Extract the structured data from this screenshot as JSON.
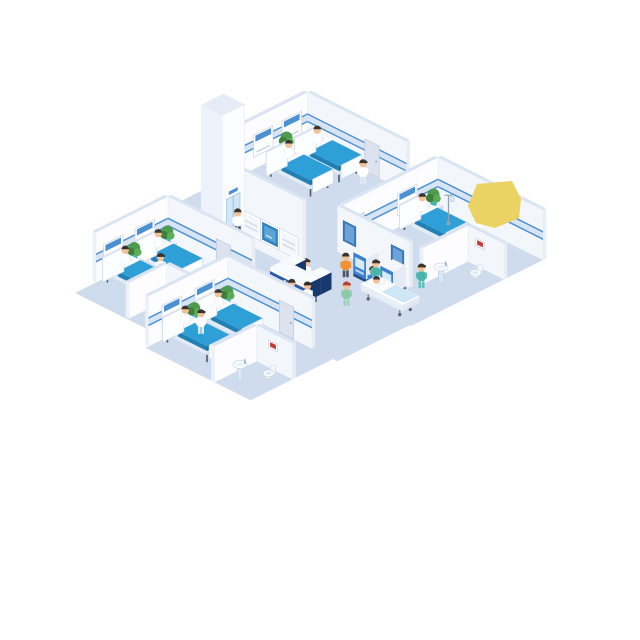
{
  "scene": {
    "description": "isometric-hospital-ward-floor-illustration",
    "desk_label": "PSN"
  },
  "palette": {
    "floor": "#cfdcee",
    "wallFaceA": "#fdfdff",
    "wallFaceB": "#f3f6fb",
    "wallTop": "#dbe4f3",
    "band": "#4a90d2",
    "bandLight": "#d6e4f4",
    "bedBlue": "#2f9fd8",
    "bedDark": "#2180b4",
    "bedEnd": "#1b6f9f",
    "leg": "#4e5a6a",
    "door": "#dde3ee",
    "desk": "#2a5ca8",
    "deskDark": "#17396e",
    "deskBand": "#0f3264",
    "kiosk": "#3d7fd0",
    "screen": "#2f86c8",
    "plant": "#4f9d4c",
    "plantDark": "#3f7f3c",
    "pot": "#49b4ac",
    "skin": "#f2c196",
    "yellow": "#ead263",
    "poster": "#3f7fc4",
    "sign": "#c43b34",
    "teal": "#4ab4aa",
    "green": "#8ccbaa",
    "orange": "#f0922e",
    "blue": "#3d7fd0"
  },
  "items": [
    {
      "t": "floor",
      "name": "floor-main-wing",
      "u1": 0,
      "v1": 0,
      "u2": 16,
      "v2": 8.8
    },
    {
      "t": "floor",
      "name": "floor-corridor",
      "u1": 2.6,
      "v1": 8.8,
      "u2": 15.9,
      "v2": 13.6
    },
    {
      "t": "floor",
      "name": "floor-left-wing",
      "u1": 2.6,
      "v1": 11.6,
      "u2": 8.6,
      "v2": 17.8
    },
    {
      "t": "floor",
      "name": "floor-bottom-wing",
      "u1": 8.6,
      "v1": 13.6,
      "u2": 15.6,
      "v2": 19.1
    },
    {
      "t": "wallA",
      "name": "top-room-headwall",
      "u": 0.3,
      "v1": 4.7,
      "v2": 0,
      "h": 50,
      "band": 1,
      "panels": [
        1.05,
        2.95
      ]
    },
    {
      "t": "wallB",
      "name": "top-room-back-wall",
      "v": 0,
      "u1": 0.3,
      "u2": 6.9,
      "h": 50,
      "band": 1,
      "door": 4.6
    },
    {
      "t": "plant",
      "name": "plant",
      "u": 0.5,
      "v": 1.6
    },
    {
      "t": "bed",
      "name": "patient-bed",
      "u": 1.2,
      "v": 0.3
    },
    {
      "t": "bed",
      "name": "patient-bed",
      "u": 1.2,
      "v": 2.2
    },
    {
      "t": "person",
      "name": "nurse",
      "u": 4.9,
      "v": 0.9,
      "role": "nurse"
    },
    {
      "t": "wallB",
      "name": "right-room-back-wall",
      "v": 0,
      "u1": 9.0,
      "u2": 16.0,
      "h": 50,
      "band": 1
    },
    {
      "t": "wallA",
      "name": "right-room-headwall",
      "u": 9.0,
      "v1": 6.3,
      "v2": 0,
      "h": 50,
      "band": 1,
      "panels": [
        2.05
      ],
      "door": 5.4
    },
    {
      "t": "plant",
      "name": "plant",
      "u": 9.2,
      "v": 0.5
    },
    {
      "t": "bed",
      "name": "patient-bed",
      "u": 9.2,
      "v": 1.3
    },
    {
      "t": "iv",
      "name": "iv-stand",
      "u": 10.4,
      "v": 0.7
    },
    {
      "t": "person",
      "name": "doctor",
      "u": 12.2,
      "v": 0.6,
      "role": "doctor"
    },
    {
      "t": "blob",
      "name": "yellow-shape",
      "pts": [
        [
          477,
          184
        ],
        [
          512,
          181
        ],
        [
          521,
          199
        ],
        [
          519,
          218
        ],
        [
          495,
          228
        ],
        [
          476,
          223
        ],
        [
          468,
          206
        ]
      ]
    },
    {
      "t": "wallB",
      "name": "right-bathroom-wall",
      "v": 2.6,
      "u1": 13.6,
      "u2": 16.0,
      "h": 36,
      "sign": 14.4
    },
    {
      "t": "wallA",
      "name": "right-bathroom-partition",
      "u": 13.6,
      "v1": 5.6,
      "v2": 2.6,
      "h": 36
    },
    {
      "t": "sink",
      "name": "sink",
      "u": 14.1,
      "v": 4.9
    },
    {
      "t": "toilet",
      "name": "toilet",
      "u": 15.1,
      "v": 3.6
    },
    {
      "t": "wallB",
      "name": "corridor-wall",
      "v": 6.3,
      "u1": 8.6,
      "u2": 13.4,
      "h": 46,
      "posters": [
        9.4,
        12.6
      ]
    },
    {
      "t": "person",
      "name": "nurse",
      "u": 13.8,
      "v": 5.9,
      "role": "tealNurse"
    },
    {
      "t": "wallB",
      "name": "reception-back-wall",
      "v": 8.8,
      "u1": 4.5,
      "u2": 8.8,
      "h": 72,
      "windows": [
        [
          5.35,
          "panel"
        ],
        [
          6.6,
          "screen"
        ],
        [
          7.85,
          "panel"
        ]
      ]
    },
    {
      "t": "elevator",
      "name": "elevator-shaft",
      "u1": 2.0,
      "v1": 7.3,
      "u2": 3.4,
      "v2": 8.8,
      "h": 116
    },
    {
      "t": "person",
      "name": "person-waiting-elevator",
      "u": 4.0,
      "v": 8.35,
      "role": "visitor"
    },
    {
      "t": "kiosk",
      "name": "self-service-kiosk",
      "u": 10.75,
      "v": 6.55
    },
    {
      "t": "kiosk",
      "name": "self-service-kiosk",
      "u": 12.55,
      "v": 6.55
    },
    {
      "t": "person",
      "name": "kiosk-user",
      "u": 10.55,
      "v": 7.7,
      "role": "orange"
    },
    {
      "t": "person",
      "name": "kiosk-user",
      "u": 12.35,
      "v": 7.7,
      "role": "blueShirt"
    },
    {
      "t": "person",
      "name": "receptionist",
      "u": 9.6,
      "v": 9.4,
      "role": "nurse"
    },
    {
      "t": "desk",
      "name": "reception-desk",
      "u1": 8.5,
      "v1": 9.0,
      "u2": 10.9,
      "v2": 10.7,
      "h": 17
    },
    {
      "t": "person",
      "name": "nurse-with-gurney",
      "u": 12.0,
      "v": 7.15,
      "role": "tealNurse"
    },
    {
      "t": "gurney",
      "name": "patient-gurney",
      "u": 12.5,
      "v": 7.55
    },
    {
      "t": "person",
      "name": "nurse-walking",
      "u": 12.5,
      "v": 9.6,
      "role": "greenNurse"
    },
    {
      "t": "person",
      "name": "staff-walking",
      "u": 10.5,
      "v": 11.25,
      "role": "blueStaff"
    },
    {
      "t": "person",
      "name": "doctor-with-bag",
      "u": 11.2,
      "v": 10.9,
      "role": "doctor",
      "bag": true
    },
    {
      "t": "wallA",
      "name": "left-room-headwall",
      "u": 2.6,
      "v1": 16.4,
      "v2": 11.6,
      "h": 50,
      "band": 1,
      "panels": [
        13.15,
        15.25
      ]
    },
    {
      "t": "wallB",
      "name": "left-room-corridor-wall",
      "v": 11.6,
      "u1": 2.6,
      "u2": 8.2,
      "h": 50,
      "band": 1,
      "door": 6.3
    },
    {
      "t": "plant",
      "name": "plant",
      "u": 2.8,
      "v": 11.85
    },
    {
      "t": "bed",
      "name": "patient-bed",
      "u": 2.8,
      "v": 12.5
    },
    {
      "t": "plant",
      "name": "plant",
      "u": 2.8,
      "v": 14.05
    },
    {
      "t": "bed",
      "name": "patient-bed",
      "u": 2.8,
      "v": 14.7
    },
    {
      "t": "person",
      "name": "nurse",
      "u": 4.4,
      "v": 13.9,
      "role": "nurse"
    },
    {
      "t": "wallB",
      "name": "left-bathroom-wall",
      "v": 15.2,
      "u1": 6.1,
      "u2": 8.6,
      "h": 36,
      "sign": 7.2
    },
    {
      "t": "wallA",
      "name": "left-bathroom-partition",
      "u": 6.1,
      "v1": 17.7,
      "v2": 15.2,
      "h": 36
    },
    {
      "t": "sink",
      "name": "sink",
      "u": 6.8,
      "v": 16.7
    },
    {
      "t": "toilet",
      "name": "toilet",
      "u": 7.8,
      "v": 15.95
    },
    {
      "t": "wallA",
      "name": "bottom-room-headwall",
      "u": 8.6,
      "v1": 18.9,
      "v2": 13.6,
      "h": 50,
      "band": 1,
      "panels": [
        15.15,
        17.35
      ]
    },
    {
      "t": "wallB",
      "name": "bottom-room-corridor-wall",
      "v": 13.6,
      "u1": 8.6,
      "u2": 14.2,
      "h": 50,
      "band": 1,
      "door": 12.5
    },
    {
      "t": "plant",
      "name": "plant",
      "u": 8.8,
      "v": 13.85
    },
    {
      "t": "bed",
      "name": "patient-bed",
      "u": 8.8,
      "v": 14.5
    },
    {
      "t": "plant",
      "name": "plant",
      "u": 8.8,
      "v": 16.05
    },
    {
      "t": "bed",
      "name": "patient-bed",
      "u": 8.8,
      "v": 16.7
    },
    {
      "t": "person",
      "name": "nurse",
      "u": 9.5,
      "v": 16.3,
      "role": "nurse"
    },
    {
      "t": "wallB",
      "name": "bottom-bathroom-wall",
      "v": 16.3,
      "u1": 13.2,
      "u2": 15.6,
      "h": 36,
      "sign": 14.3
    },
    {
      "t": "wallA",
      "name": "bottom-bathroom-partition",
      "u": 13.2,
      "v1": 19.1,
      "v2": 16.3,
      "h": 36
    },
    {
      "t": "sink",
      "name": "sink",
      "u": 13.9,
      "v": 18.1
    },
    {
      "t": "toilet",
      "name": "toilet",
      "u": 14.9,
      "v": 17.2
    }
  ]
}
